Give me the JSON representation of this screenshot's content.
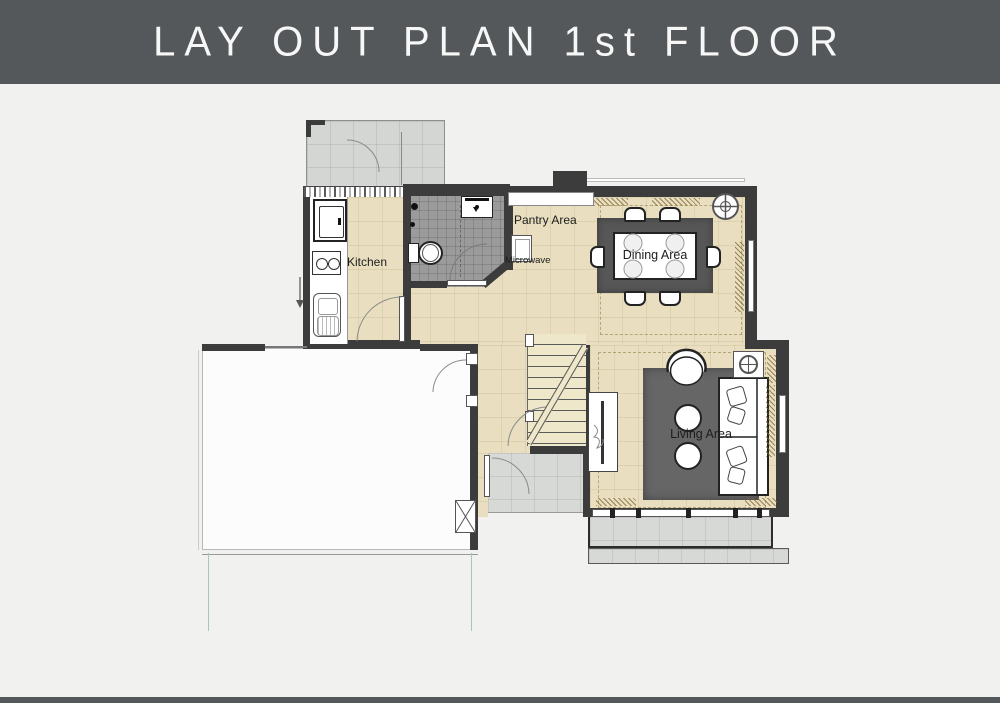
{
  "title": "LAY OUT PLAN 1st FLOOR",
  "labels": {
    "kitchen": "Kitchen",
    "pantry": "Pantry Area",
    "microwave": "Microwave",
    "dining": "Dining Area",
    "living": "Living Area"
  },
  "colors": {
    "banner": "#54585a",
    "canvas": "#f1f1ef",
    "wall": "#3c3c3c",
    "floor-beige": "#e9dfc0",
    "floor-bath": "#9b9b9b",
    "deck": "#d4d6d4",
    "paving": "#d7d9d7",
    "rug-dining": "#575757",
    "rug-living": "#666666",
    "driveway": "#a5c6c4"
  }
}
